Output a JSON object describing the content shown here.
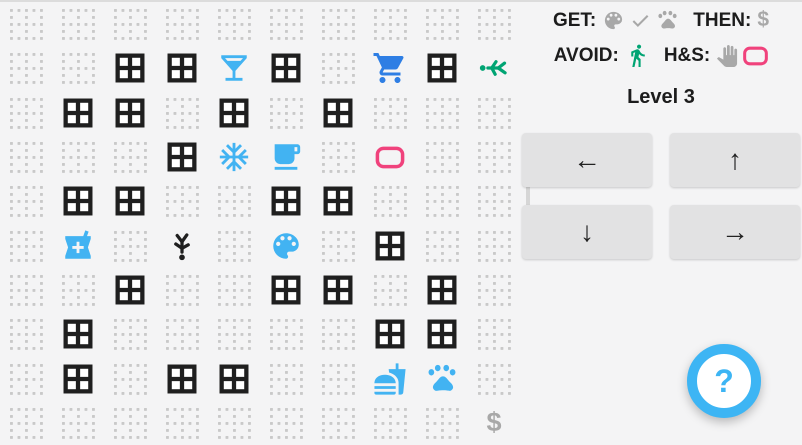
{
  "header": {
    "get_label": "GET:",
    "get_items": [
      {
        "icon": "palette-icon",
        "color": "icon_gray"
      },
      {
        "icon": "check-icon",
        "color": "icon_gray"
      },
      {
        "icon": "paw-icon",
        "color": "icon_gray"
      }
    ],
    "then_label": "THEN:",
    "then_items": [
      {
        "icon": "dollar-icon",
        "color": "icon_gray"
      }
    ],
    "avoid_label": "AVOID:",
    "avoid_items": [
      {
        "icon": "walk-icon",
        "color": "teal"
      }
    ],
    "hs_label": "H&S:",
    "hs_items": [
      {
        "icon": "hand-icon",
        "color": "icon_gray"
      },
      {
        "icon": "pink-rect-icon",
        "color": "pink"
      }
    ]
  },
  "level_label": "Level 3",
  "controls": [
    {
      "name": "left",
      "glyph": "←"
    },
    {
      "name": "up",
      "glyph": "↑"
    },
    {
      "name": "down",
      "glyph": "↓"
    },
    {
      "name": "right",
      "glyph": "→"
    }
  ],
  "help_label": "?",
  "glyphs": {
    "dollar": "$"
  },
  "colors": {
    "light_blue": "#42b3f2",
    "cart_blue": "#2e7ee4",
    "teal": "#00a473",
    "pink": "#f0427c",
    "icon_gray": "#a8a8a8",
    "ink": "#1f1f1f",
    "dot_gray": "#c9c9c9"
  },
  "board": {
    "rows": [
      [
        "empty",
        "empty",
        "empty",
        "empty",
        "empty",
        "empty",
        "empty",
        "empty",
        "empty",
        "empty"
      ],
      [
        "empty",
        "empty",
        "window",
        "window",
        "martini",
        "window",
        "empty",
        "cart",
        "window",
        "person-left"
      ],
      [
        "empty",
        "window",
        "window",
        "empty",
        "window",
        "empty",
        "window",
        "empty",
        "empty",
        "empty"
      ],
      [
        "empty",
        "empty",
        "empty",
        "window",
        "snowflake",
        "coffee",
        "empty",
        "pink-rect",
        "empty",
        "empty"
      ],
      [
        "empty",
        "window",
        "window",
        "empty",
        "empty",
        "window",
        "window",
        "empty",
        "empty",
        "empty"
      ],
      [
        "empty",
        "pharmacy",
        "empty",
        "person-down",
        "empty",
        "palette",
        "empty",
        "window",
        "empty",
        "empty"
      ],
      [
        "empty",
        "empty",
        "window",
        "empty",
        "empty",
        "window",
        "window",
        "empty",
        "window",
        "empty"
      ],
      [
        "empty",
        "window",
        "empty",
        "empty",
        "empty",
        "empty",
        "empty",
        "window",
        "window",
        "empty"
      ],
      [
        "empty",
        "window",
        "empty",
        "window",
        "window",
        "empty",
        "empty",
        "fastfood",
        "paw",
        "empty"
      ],
      [
        "empty",
        "empty",
        "empty",
        "empty",
        "empty",
        "empty",
        "empty",
        "empty",
        "empty",
        "dollar"
      ]
    ]
  }
}
